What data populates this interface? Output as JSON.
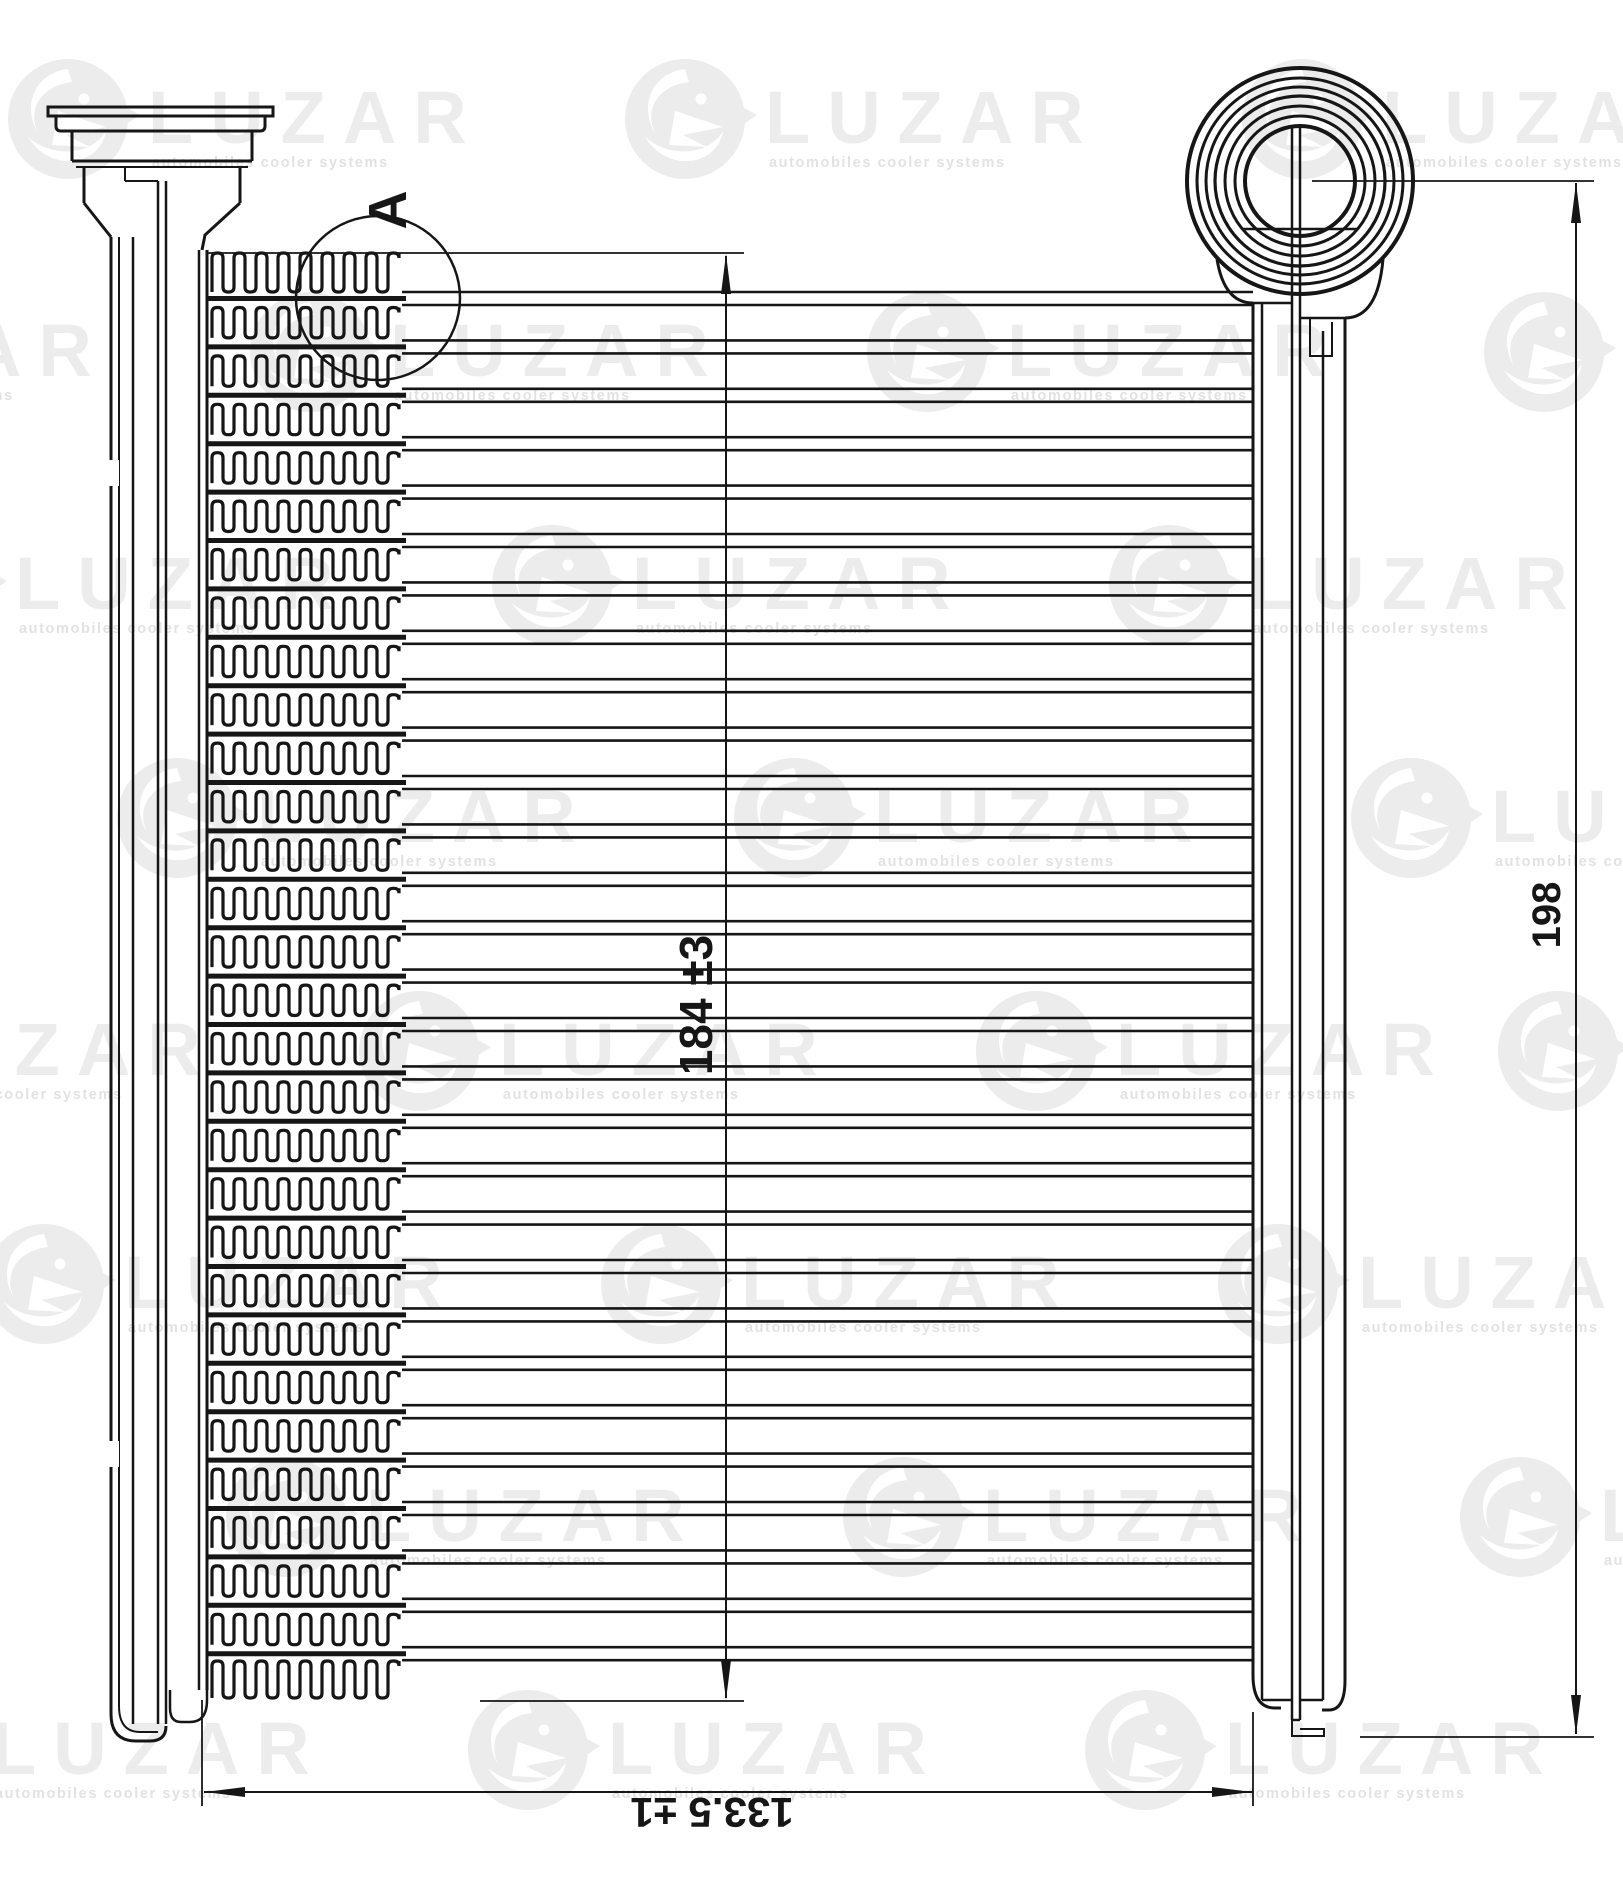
{
  "detail": {
    "label": "A"
  },
  "dimensions": {
    "core_height": "184 ±3",
    "overall_height": "198",
    "core_width": "133.5 ±1"
  },
  "watermark": {
    "brand": "LUZAR",
    "tagline": "automobiles cooler systems"
  },
  "colors": {
    "line": "#161616",
    "watermark_fill": "#ececec",
    "watermark_sub": "#e2e2e2"
  }
}
